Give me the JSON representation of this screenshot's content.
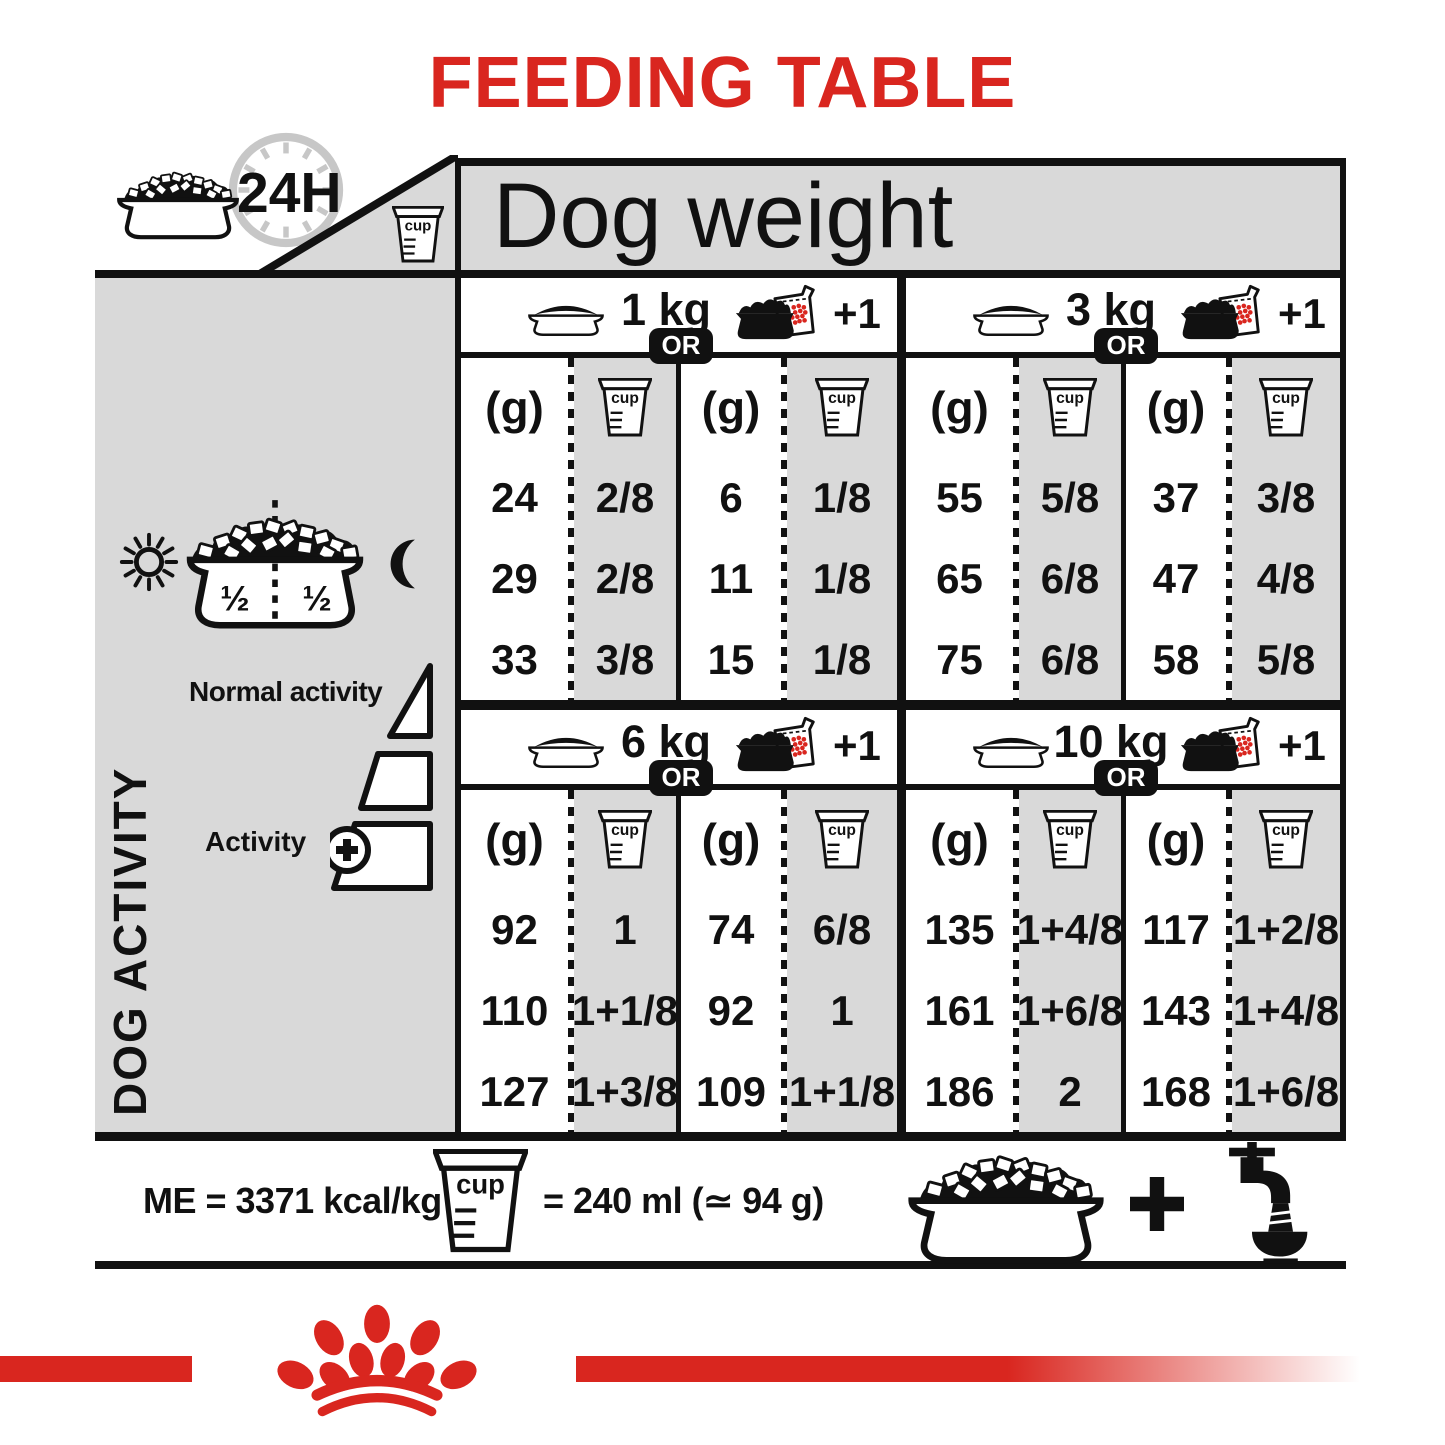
{
  "title": "FEEDING TABLE",
  "colors": {
    "accent": "#d9261f",
    "panel": "#d9d9d9",
    "ink": "#111111",
    "clock_gray": "#c7c7c7"
  },
  "labels": {
    "dog_weight": "Dog weight",
    "duration": "24H",
    "cup": "cup",
    "or": "OR",
    "plus_one": "+1",
    "grams": "(g)"
  },
  "sidebar": {
    "dog_activity": "DOG ACTIVITY",
    "normal_activity": "Normal activity",
    "activity": "Activity",
    "half": "½"
  },
  "sections": [
    {
      "weight": "1 kg",
      "dry": {
        "g": [
          "24",
          "29",
          "33"
        ],
        "cups": [
          "2/8",
          "2/8",
          "3/8"
        ]
      },
      "pouch": {
        "g": [
          "6",
          "11",
          "15"
        ],
        "cups": [
          "1/8",
          "1/8",
          "1/8"
        ]
      }
    },
    {
      "weight": "3 kg",
      "dry": {
        "g": [
          "55",
          "65",
          "75"
        ],
        "cups": [
          "5/8",
          "6/8",
          "6/8"
        ]
      },
      "pouch": {
        "g": [
          "37",
          "47",
          "58"
        ],
        "cups": [
          "3/8",
          "4/8",
          "5/8"
        ]
      }
    },
    {
      "weight": "6 kg",
      "dry": {
        "g": [
          "92",
          "110",
          "127"
        ],
        "cups": [
          "1",
          "1+1/8",
          "1+3/8"
        ]
      },
      "pouch": {
        "g": [
          "74",
          "92",
          "109"
        ],
        "cups": [
          "6/8",
          "1",
          "1+1/8"
        ]
      }
    },
    {
      "weight": "10 kg",
      "dry": {
        "g": [
          "135",
          "161",
          "186"
        ],
        "cups": [
          "1+4/8",
          "1+6/8",
          "2"
        ]
      },
      "pouch": {
        "g": [
          "117",
          "143",
          "168"
        ],
        "cups": [
          "1+2/8",
          "1+4/8",
          "1+6/8"
        ]
      }
    }
  ],
  "footer": {
    "energy": "ME = 3371 kcal/kg",
    "cup_equivalence": "= 240 ml (≃ 94 g)"
  }
}
